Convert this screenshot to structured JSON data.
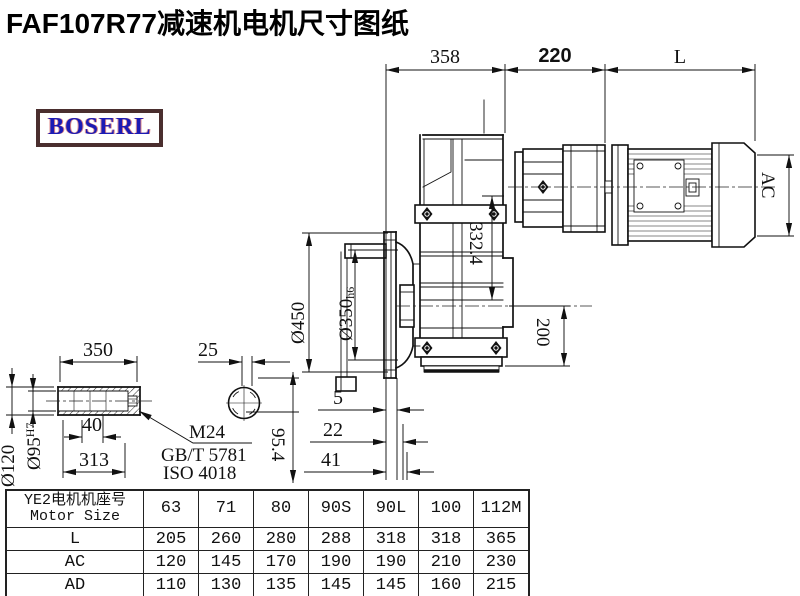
{
  "page": {
    "title": "FAF107R77减速机电机尺寸图纸"
  },
  "logo": {
    "text": "BOSERL"
  },
  "drawing": {
    "dims": {
      "top_358": "358",
      "top_220": "220",
      "top_L": "L",
      "ac": "AC",
      "v332": "332.4",
      "v200": "200",
      "dia450": "Ø450",
      "dia350": "Ø350",
      "dia350_tol": "h6",
      "off5": "5",
      "off22": "22",
      "off41": "41",
      "shaft_350": "350",
      "shaft_40": "40",
      "shaft_313": "313",
      "shaft_25": "25",
      "shaft_954": "95.4",
      "dia120": "Ø120",
      "dia95": "Ø95",
      "dia95_tol": "H7",
      "thread": "M24",
      "std_gb": "GB/T 5781",
      "std_iso": "ISO 4018"
    }
  },
  "table": {
    "header": {
      "line1": "YE2电机机座号",
      "line2": "Motor Size"
    },
    "sizes": [
      "63",
      "71",
      "80",
      "90S",
      "90L",
      "100",
      "112M"
    ],
    "rows": [
      {
        "label": "L",
        "values": [
          "205",
          "260",
          "280",
          "288",
          "318",
          "318",
          "365"
        ]
      },
      {
        "label": "AC",
        "values": [
          "120",
          "145",
          "170",
          "190",
          "190",
          "210",
          "230"
        ]
      },
      {
        "label": "AD",
        "values": [
          "110",
          "130",
          "135",
          "145",
          "145",
          "160",
          "215"
        ]
      }
    ]
  }
}
